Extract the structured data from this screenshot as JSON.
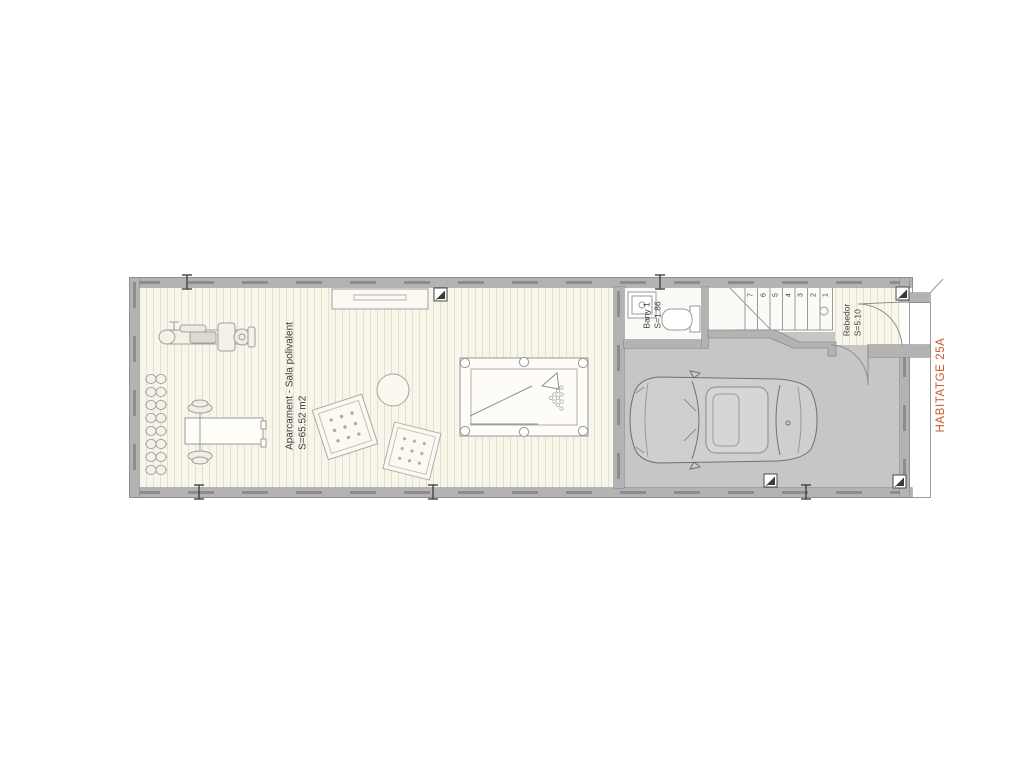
{
  "drawing": {
    "type": "architectural-floor-plan",
    "unit_label": "HABITATGE 25A",
    "rooms": {
      "sala": {
        "name": "Aparcament - Sala polivalent",
        "area": "S=65.52 m2"
      },
      "bany": {
        "name": "Bany 1",
        "area": "S=1.86"
      },
      "rebedor": {
        "name": "Rebedor",
        "area": "S=5.10"
      }
    },
    "stairs": {
      "steps": [
        "7",
        "6",
        "5",
        "4",
        "3",
        "2",
        "1"
      ]
    },
    "furniture": [
      "exercise-machine",
      "dumbbell-rack",
      "weight-bench-with-barbell",
      "exercise-ball",
      "floor-mat",
      "floor-mat",
      "pool-table",
      "shelf",
      "sink",
      "toilet",
      "car"
    ],
    "colors": {
      "accent_orange": "#c75b2a",
      "wall_gray": "#b3b3b3",
      "garage_floor": "#c6c6c6",
      "parquet_floor": "#f8f5eb",
      "line_gray": "#9a9a9a",
      "text_dark": "#3c3c3c"
    }
  }
}
